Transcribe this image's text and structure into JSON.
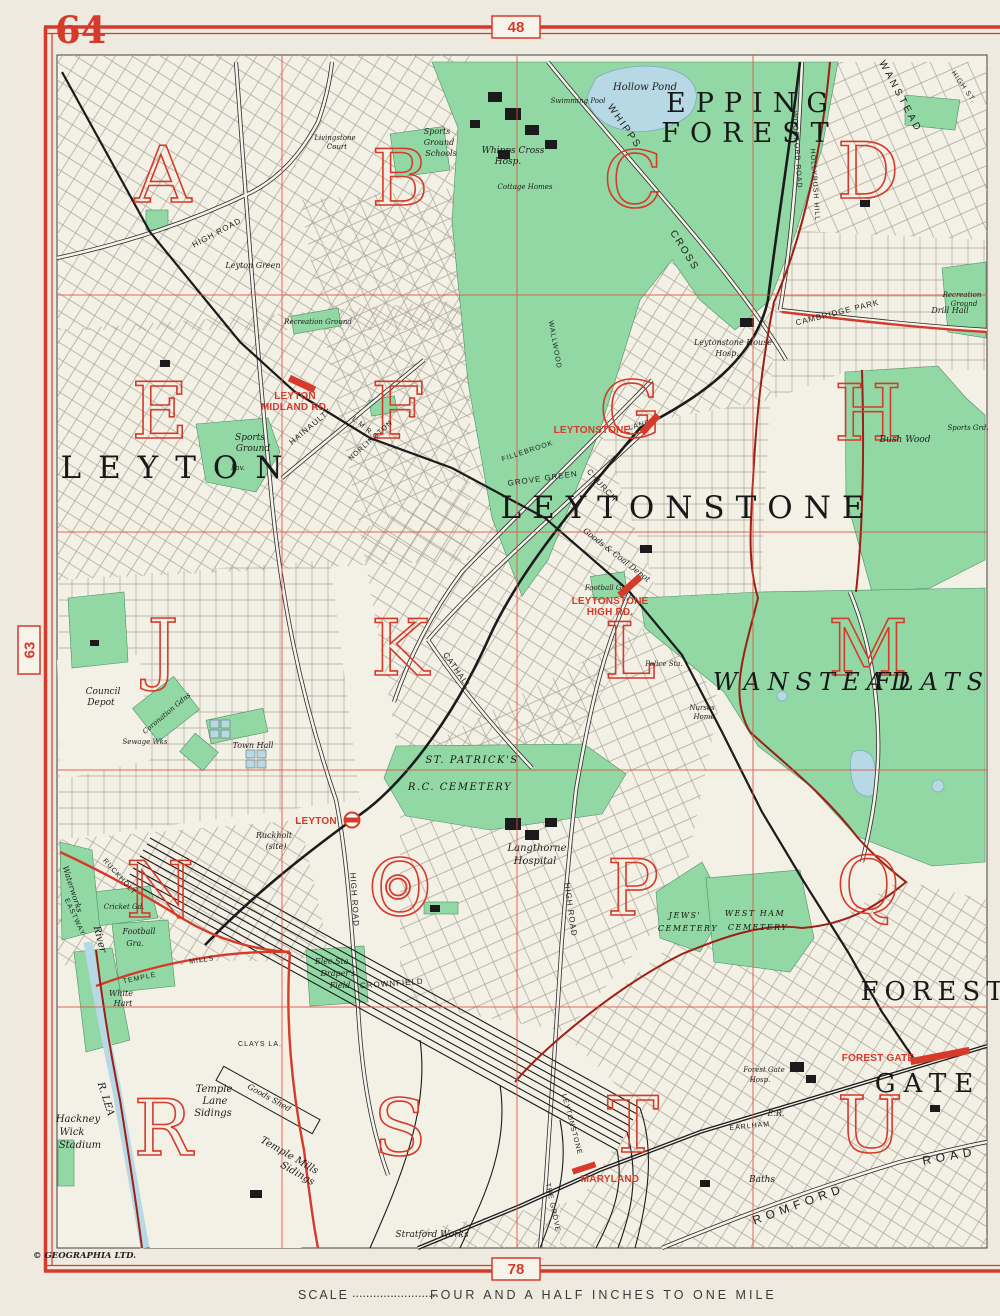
{
  "page": {
    "number": "64",
    "grid_ref_top": "48",
    "grid_ref_bottom": "78",
    "grid_ref_left": "63",
    "scale_prefix": "SCALE",
    "scale_dots": ".........................",
    "scale_text": "FOUR AND A HALF INCHES TO ONE MILE",
    "copyright": "© GEOGRAPHIA LTD."
  },
  "colors": {
    "paper": "#eeeadf",
    "map_bg": "#f3f0e6",
    "park_green": "#92d8a5",
    "water_blue": "#b7d8e5",
    "accent_red": "#d63a2a",
    "boundary_red": "#9c2015",
    "ink": "#1d1d1b",
    "street_line": "#a9a496"
  },
  "grid_letters": [
    "A",
    "B",
    "C",
    "D",
    "E",
    "F",
    "G",
    "H",
    "J",
    "K",
    "L",
    "M",
    "N",
    "O",
    "P",
    "Q",
    "R",
    "S",
    "T",
    "U"
  ],
  "districts": {
    "epping_1": "EPPING",
    "epping_2": "FOREST",
    "leytonstone": "LEYTONSTONE",
    "leyton": "LEYTON",
    "wanstead": "WANSTEAD",
    "flats": "FLATS",
    "forest": "FOREST",
    "gate": "GATE"
  },
  "stations": {
    "leyton_midland_1": "LEYTON",
    "leyton_midland_2": "MIDLAND RD.",
    "leytonstone": "LEYTONSTONE",
    "leytonstone_high_1": "LEYTONSTONE",
    "leytonstone_high_2": "HIGH RD.",
    "leyton": "LEYTON",
    "forest_gate": "FOREST GATE",
    "maryland": "MARYLAND"
  },
  "roads": {
    "whipps": "WHIPPS",
    "cross": "CROSS",
    "woodford": "WOODFORD ROAD",
    "hollybush": "HOLLYBUSH HILL",
    "wanstead_diag": "WANSTEAD",
    "high_st": "HIGH ST.",
    "cambridge_park": "CAMBRIDGE PARK",
    "hainault": "HAINAULT",
    "norlington": "NORLINGTON",
    "lmr": "L.M.R.",
    "grove_green": "GROVE GREEN",
    "fillebrook": "FILLEBROOK",
    "wallwood": "WALLWOOD",
    "church": "CHURCH",
    "lane": "LANE",
    "cathall": "CATHALL",
    "high_road_nw": "HIGH ROAD",
    "high_road_leyton": "HIGH ROAD",
    "high_road_leytonstone": "HIGH ROAD",
    "crownfield": "CROWNFIELD",
    "leytonstone_rd": "LEYTONSTONE",
    "the_grove": "THE GROVE",
    "romford": "ROMFORD",
    "road2": "ROAD",
    "earlham": "EARLHAM",
    "temple": "TEMPLE",
    "mills": "MILLS",
    "eastway": "EASTWAY",
    "ruckholt": "RUCKHOLT",
    "clays_la": "CLAYS LA."
  },
  "features": {
    "hollow_pond": "Hollow Pond",
    "whipps_hosp_1": "Whipps Cross",
    "whipps_hosp_2": "Hosp.",
    "swimming_pool": "Swimming Pool",
    "cottage_homes": "Cottage Homes",
    "sports_schools_1": "Sports",
    "sports_schools_2": "Ground",
    "sports_schools_3": "Schools",
    "livingstone_1": "Livingstone",
    "livingstone_2": "Court",
    "leyton_green": "Leyton Green",
    "recreation_1": "Recreation Ground",
    "recreation_2a": "Recreation",
    "recreation_2b": "Ground",
    "sports_ground_1": "Sports",
    "sports_ground_2": "Ground",
    "pav": "Pav.",
    "leytonstone_house_1": "Leytonstone House",
    "leytonstone_house_2": "Hosp.",
    "drill_hall": "Drill Hall",
    "bush_wood": "Bush Wood",
    "sports_grd": "Sports Grd.",
    "council_1": "Council",
    "council_2": "Depot",
    "coronation": "Coronation Gdns",
    "sewage": "Sewage Wks",
    "town_hall": "Town Hall",
    "st_patricks_1": "ST. PATRICK'S",
    "st_patricks_2": "R.C. CEMETERY",
    "langthorne_1": "Langthorne",
    "langthorne_2": "Hospital",
    "jews_1": "JEWS'",
    "jews_2": "CEMETERY",
    "west_ham_1": "WEST HAM",
    "west_ham_2": "CEMETERY",
    "goods_coal": "Goods & Coal Depot",
    "football_gro": "Football Gro.",
    "police_sta": "Police Sta.",
    "nurses_1": "Nurses",
    "nurses_2": "Home",
    "hackney_1": "Hackney",
    "hackney_2": "Wick",
    "hackney_3": "Stadium",
    "r_lea": "R. LEA",
    "river": "River",
    "white_hart_1": "White",
    "white_hart_2": "Hart",
    "temple_lane_1": "Temple",
    "temple_lane_2": "Lane",
    "temple_lane_3": "Sidings",
    "goods_shed": "Goods Shed",
    "temple_mills_1": "Temple Mills",
    "temple_mills_2": "Sidings",
    "ruckholt_site_1": "Ruckholt",
    "ruckholt_site_2": "(site)",
    "cricket": "Cricket Gd.",
    "football_gra_1": "Football",
    "football_gra_2": "Gra.",
    "waterworks": "Waterworks",
    "elec_sta": "Elec.Sta.",
    "drapers_1": "Draper's",
    "drapers_2": "Field",
    "forest_gate_hosp_1": "Forest Gate",
    "forest_gate_hosp_2": "Hosp.",
    "baths": "Baths",
    "er": "E.R.",
    "stratford_works": "Stratford Works"
  }
}
